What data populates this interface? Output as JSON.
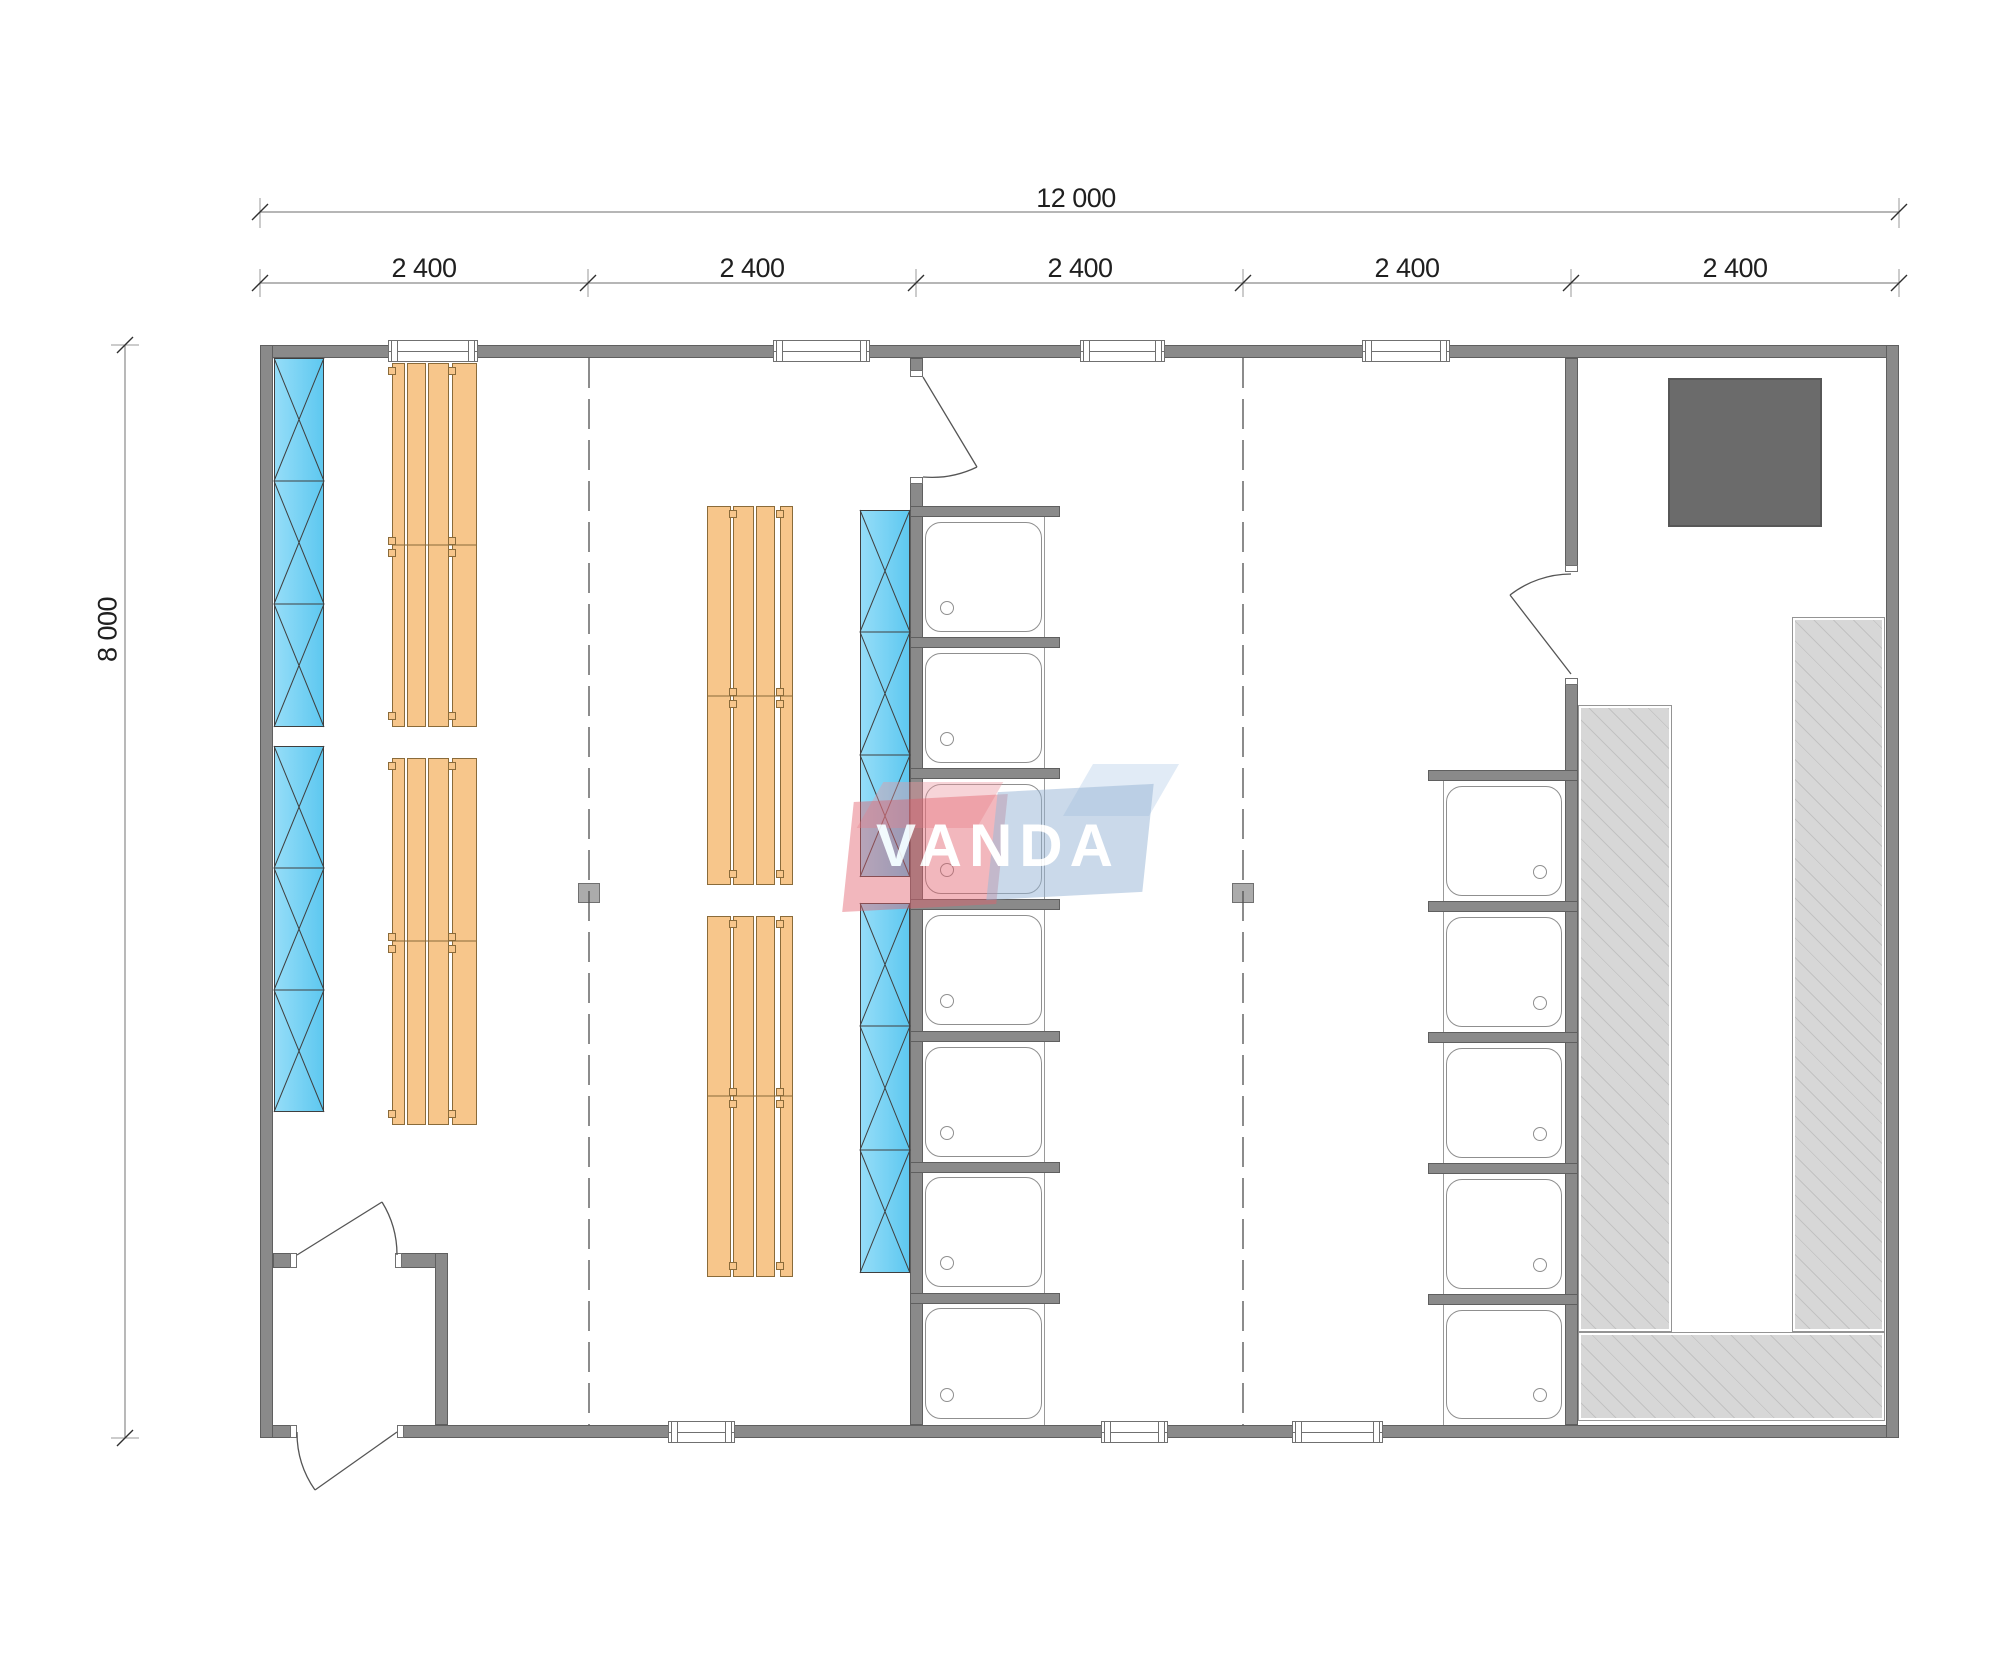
{
  "drawing": {
    "type": "modular building floor plan, top view",
    "dimensions": {
      "total_width": "12 000",
      "bays": [
        "2 400",
        "2 400",
        "2 400",
        "2 400",
        "2 400"
      ],
      "total_height": "8 000"
    },
    "watermark": {
      "text": "VANDA",
      "red": "#e2606c",
      "blue": "#94b2d4"
    },
    "counts": {
      "windows_top_wall": 4,
      "windows_bottom_wall": 3,
      "doors": 4,
      "shower_trays_left_column": 7,
      "shower_trays_right_column": 5,
      "wood_bench_groups": 4,
      "cross_braced_bench_strips": 4,
      "support_posts": 2,
      "stoves": 1
    },
    "colors": {
      "wall": "#8a8a8a",
      "bench_wood": "#f7c68b",
      "cross_strip_blue": "#7bd2f2",
      "platform_gray": "#d7d7d7",
      "stove": "#6b6b6b"
    }
  }
}
